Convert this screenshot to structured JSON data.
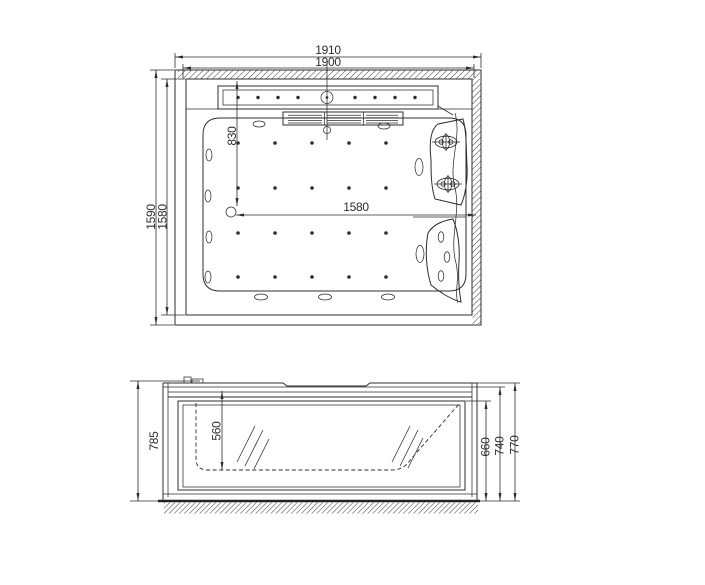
{
  "drawing": {
    "kind": "bathtub two-view dimensional drawing"
  },
  "plan_view": {
    "overall_width": "1910",
    "rim_width": "1900",
    "overall_depth": "1590",
    "rim_depth": "1580",
    "interior_length": "1580",
    "jet_offset": "830"
  },
  "elevation_view": {
    "overall_height": "785",
    "interior_depth": "560",
    "apron_height": "660",
    "rim_height": "740",
    "deck_height": "770"
  }
}
